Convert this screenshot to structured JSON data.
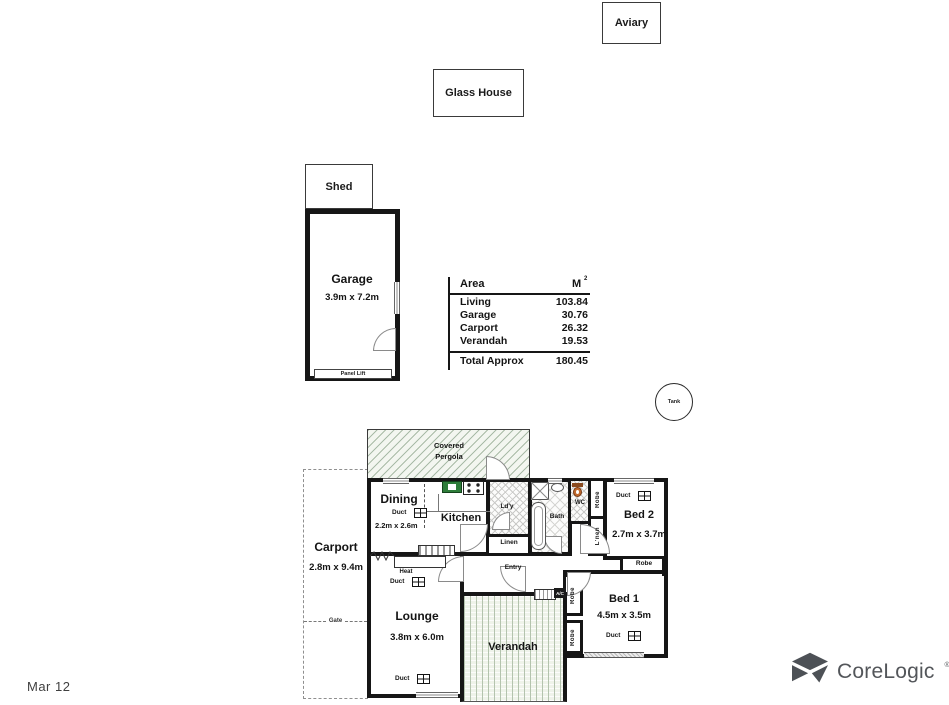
{
  "meta": {
    "date_label": "Mar 12"
  },
  "branding": {
    "name": "CoreLogic",
    "mark": "®",
    "color": "#53565a"
  },
  "icons": {
    "corelogic_mark": "three-triangle-pinwheel",
    "duct": "four-pane-grid-box",
    "heat": "zigzag-heater",
    "tank": "circle"
  },
  "outbuildings": {
    "aviary": {
      "label": "Aviary"
    },
    "glass_house": {
      "label": "Glass House"
    },
    "shed": {
      "label": "Shed"
    },
    "garage": {
      "label": "Garage",
      "dims": "3.9m x 7.2m",
      "door_label": "Panel Lift"
    },
    "tank": {
      "label": "Tank"
    }
  },
  "area_table": {
    "header": {
      "area": "Area",
      "unit": "M",
      "unit_sup": "2"
    },
    "rows": [
      {
        "label": "Living",
        "value": "103.84"
      },
      {
        "label": "Garage",
        "value": "30.76"
      },
      {
        "label": "Carport",
        "value": "26.32"
      },
      {
        "label": "Verandah",
        "value": "19.53"
      }
    ],
    "total": {
      "label": "Total Approx",
      "value": "180.45"
    }
  },
  "floorplan": {
    "pergola": {
      "line1": "Covered",
      "line2": "Pergola"
    },
    "rooms": {
      "dining": {
        "name": "Dining",
        "dims": "2.2m x 2.6m"
      },
      "kitchen": {
        "name": "Kitchen"
      },
      "laundry": {
        "name": "Ld'y"
      },
      "linen": {
        "name": "Linen"
      },
      "bath": {
        "name": "Bath"
      },
      "wc": {
        "name": "WC"
      },
      "bed2": {
        "name": "Bed 2",
        "dims": "2.7m x 3.7m"
      },
      "bed1": {
        "name": "Bed 1",
        "dims": "4.5m x 3.5m"
      },
      "lounge": {
        "name": "Lounge",
        "dims": "3.8m x 6.0m"
      },
      "verandah": {
        "name": "Verandah"
      },
      "carport": {
        "name": "Carport",
        "dims": "2.8m x 9.4m"
      },
      "entry": {
        "name": "Entry"
      }
    },
    "fixtures": {
      "duct": "Duct",
      "heat": "Heat",
      "robe": "Robe",
      "linen_vertical": "L'nen",
      "gate": "Gate",
      "ac": "A/C"
    },
    "colors": {
      "wall": "#161616",
      "pergola_hatch": "#a9bba7",
      "verandah_stripe": "#b4c3ae",
      "sink_green": "#2e7d3a",
      "toilet_orange": "#b65c24"
    }
  }
}
